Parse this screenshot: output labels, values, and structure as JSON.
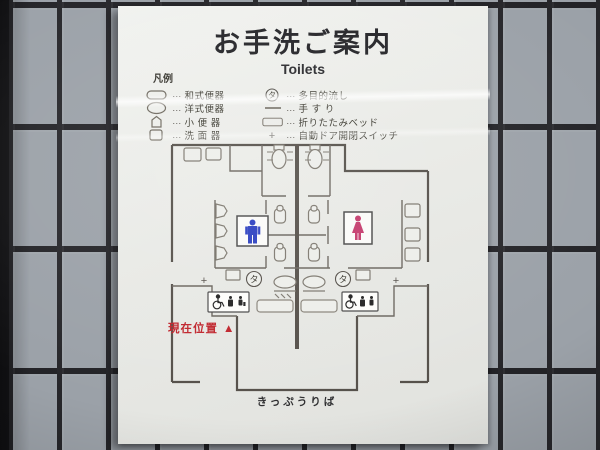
{
  "sign": {
    "title": "お手洗ご案内",
    "subtitle": "Toilets",
    "legend": {
      "heading": "凡例",
      "dots": "…",
      "left": [
        {
          "symbol": "squat-toilet-symbol",
          "label": "和式便器"
        },
        {
          "symbol": "western-toilet-symbol",
          "label": "洋式便器"
        },
        {
          "symbol": "urinal-symbol",
          "label": "小 便 器"
        },
        {
          "symbol": "washbasin-symbol",
          "label": "洗 面 器"
        }
      ],
      "right": [
        {
          "symbol": "multi-purpose-sink-symbol",
          "symbol_char": "タ",
          "label": "多目的流し"
        },
        {
          "symbol": "handrail-symbol",
          "label": "手 す り"
        },
        {
          "symbol": "folding-bed-symbol",
          "label": "折りたたみベッド"
        },
        {
          "symbol": "auto-door-switch-symbol",
          "symbol_char": "+",
          "label": "自動ドア開閉スイッチ"
        }
      ]
    },
    "plan": {
      "current_location": "現在位置",
      "current_location_marker": "▲",
      "multi_sink_char": "タ",
      "switch_char": "+",
      "ticket_area": "きっぷうりば"
    },
    "colors": {
      "male": "#2b3fc0",
      "female": "#c43a6c",
      "current_location": "#c0242c",
      "wall_line": "#55504a"
    }
  }
}
